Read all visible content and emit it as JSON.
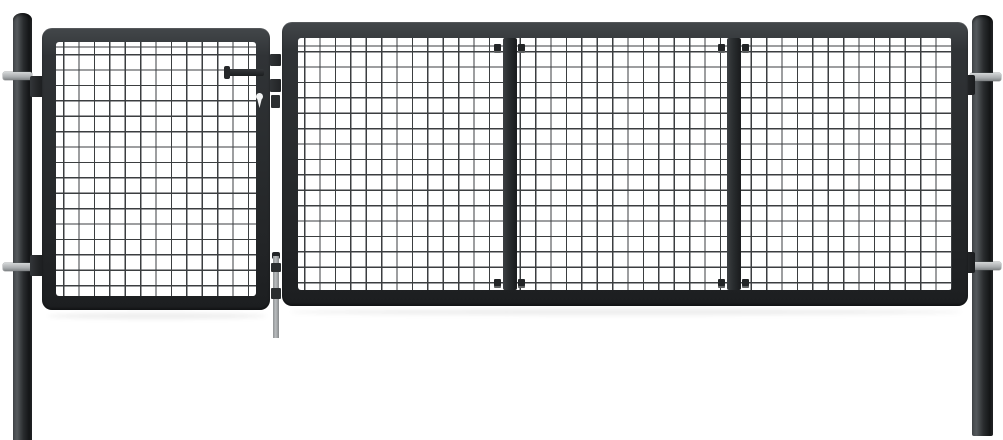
{
  "scene": {
    "type": "product-photo",
    "description": "Anthracite grey steel garden gate with welded mesh infill: narrow wicket door on the left, wide three-section panel on the right, mounted between two round fence posts on a plain white background",
    "background_color": "#ffffff"
  },
  "colors": {
    "background": "#ffffff",
    "frame_top_light": "#43474a",
    "frame_mid": "#292c2e",
    "frame_dark": "#1c1e20",
    "mesh_wire": "#3b3e40",
    "post_light": "#474b4e",
    "post_dark": "#141617",
    "hardware_metal": "#aaadaf",
    "hardware_metal_light": "#d3d6d7",
    "hardware_dark": "#222426",
    "rod_metal": "#b9bcbe",
    "shadow": "rgba(0,0,0,0.07)"
  },
  "mesh": {
    "cell_px": 15.4,
    "wire_px": 1.3
  },
  "parts": {
    "left_post": "Round steel fence post (left) with two clamp bolts",
    "right_post": "Round steel fence post (right) with two clamp bolts",
    "wicket_door": "Narrow hinged door with welded mesh infill",
    "main_panel": "Wide gate panel with welded mesh infill and two vertical stiffener bars",
    "handle": "Horizontal lock handle on the door's right stile",
    "keyhole": "Cylinder lock keyhole below the handle",
    "latch_hardware": "Latch and striker tabs between door and panel",
    "drop_rod": "Galvanised drop bolt hanging below the latch gap",
    "mesh_clips": "Small clips fixing the mesh to the stiffener bars"
  }
}
